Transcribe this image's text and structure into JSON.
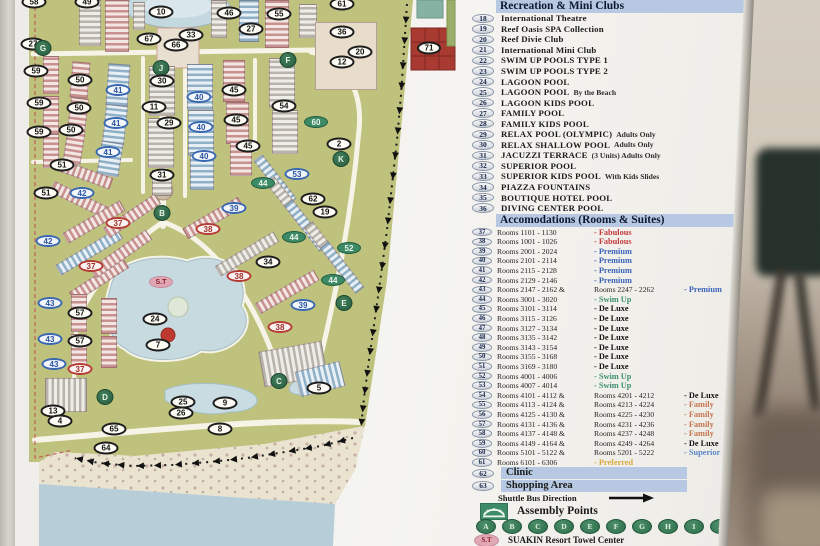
{
  "legend": {
    "section1_title": "Recreation & Mini Clubs",
    "recreation": [
      {
        "num": "18",
        "label": "International Theatre"
      },
      {
        "num": "19",
        "label": "Reef Oasis SPA Collection"
      },
      {
        "num": "20",
        "label": "Reef Divie Club"
      },
      {
        "num": "21",
        "label": "International Mini Club"
      },
      {
        "num": "22",
        "label": "SWIM UP POOLS TYPE 1"
      },
      {
        "num": "23",
        "label": "SWIM UP POOLS TYPE 2"
      },
      {
        "num": "24",
        "label": "LAGOON POOL"
      },
      {
        "num": "25",
        "label": "LAGOON POOL",
        "note": "By the Beach"
      },
      {
        "num": "26",
        "label": "LAGOON KIDS POOL"
      },
      {
        "num": "27",
        "label": "FAMILY POOL"
      },
      {
        "num": "28",
        "label": "FAMILY KIDS POOL"
      },
      {
        "num": "29",
        "label": "RELAX POOL (OLYMPIC)",
        "note": "Adults Only"
      },
      {
        "num": "30",
        "label": "RELAX SHALLOW POOL",
        "note": "Adults Only"
      },
      {
        "num": "31",
        "label": "JACUZZI TERRACE",
        "note": "(3 Units) Adults Only"
      },
      {
        "num": "32",
        "label": "SUPERIOR POOL"
      },
      {
        "num": "33",
        "label": "SUPERIOR KIDS POOL",
        "note": "With Kids Slides"
      },
      {
        "num": "34",
        "label": "PIAZZA FOUNTAINS"
      },
      {
        "num": "35",
        "label": "BOUTIQUE HOTEL POOL"
      },
      {
        "num": "36",
        "label": "DIVING CENTER POOL"
      }
    ],
    "section2_title": "Accomodations (Rooms & Suites)",
    "rooms": [
      {
        "num": "37",
        "rooms": "Rooms 1101 - 1130",
        "cat": "Fabulous",
        "style": "fab"
      },
      {
        "num": "38",
        "rooms": "Rooms 1001 - 1026",
        "cat": "Fabulous",
        "style": "fab"
      },
      {
        "num": "39",
        "rooms": "Rooms 2001 - 2024",
        "cat": "Premium",
        "style": "pre"
      },
      {
        "num": "40",
        "rooms": "Rooms 2101 - 2114",
        "cat": "Premium",
        "style": "pre"
      },
      {
        "num": "41",
        "rooms": "Rooms 2115 - 2128",
        "cat": "Premium",
        "style": "pre"
      },
      {
        "num": "42",
        "rooms": "Rooms 2129 - 2146",
        "cat": "Premium",
        "style": "pre"
      },
      {
        "num": "43",
        "rooms": "Rooms 2147 - 2162 &",
        "rooms2": "Rooms 2247 - 2262",
        "cat": "Premium",
        "style": "pre"
      },
      {
        "num": "44",
        "rooms": "Rooms 3001 - 3020",
        "cat": "Swim Up",
        "style": "swim"
      },
      {
        "num": "45",
        "rooms": "Rooms 3101 - 3114",
        "cat": "De Luxe",
        "style": "del"
      },
      {
        "num": "46",
        "rooms": "Rooms 3115 - 3126",
        "cat": "De Luxe",
        "style": "del"
      },
      {
        "num": "47",
        "rooms": "Rooms 3127 - 3134",
        "cat": "De Luxe",
        "style": "del"
      },
      {
        "num": "48",
        "rooms": "Rooms 3135 - 3142",
        "cat": "De Luxe",
        "style": "del"
      },
      {
        "num": "49",
        "rooms": "Rooms 3143 - 3154",
        "cat": "De Luxe",
        "style": "del"
      },
      {
        "num": "50",
        "rooms": "Rooms 3155 - 3168",
        "cat": "De Luxe",
        "style": "del"
      },
      {
        "num": "51",
        "rooms": "Rooms 3169 - 3180",
        "cat": "De Luxe",
        "style": "del"
      },
      {
        "num": "52",
        "rooms": "Rooms 4001 - 4006",
        "cat": "Swim Up",
        "style": "swim"
      },
      {
        "num": "53",
        "rooms": "Rooms 4007 - 4014",
        "cat": "Swim Up",
        "style": "swim"
      },
      {
        "num": "54",
        "rooms": "Rooms 4101 - 4112 &",
        "rooms2": "Rooms 4201 - 4212",
        "cat": "De Luxe",
        "style": "del"
      },
      {
        "num": "55",
        "rooms": "Rooms 4113 - 4124 &",
        "rooms2": "Rooms 4213 - 4224",
        "cat": "Family",
        "style": "fam"
      },
      {
        "num": "56",
        "rooms": "Rooms 4125 - 4130 &",
        "rooms2": "Rooms 4225 - 4230",
        "cat": "Family",
        "style": "fam"
      },
      {
        "num": "57",
        "rooms": "Rooms 4131 - 4136 &",
        "rooms2": "Rooms 4231 - 4236",
        "cat": "Family",
        "style": "fam"
      },
      {
        "num": "58",
        "rooms": "Rooms 4137 - 4148 &",
        "rooms2": "Rooms 4237 - 4248",
        "cat": "Family",
        "style": "fam"
      },
      {
        "num": "59",
        "rooms": "Rooms 4149 - 4164 &",
        "rooms2": "Rooms 4249 - 4264",
        "cat": "De Luxe",
        "style": "del"
      },
      {
        "num": "60",
        "rooms": "Rooms 5101 - 5122 &",
        "rooms2": "Rooms 5201 - 5222",
        "cat": "Superior Comfort",
        "style": "sup"
      },
      {
        "num": "61",
        "rooms": "Rooms 6101 - 6306",
        "cat": "Preferred",
        "style": "pref"
      }
    ],
    "facilities": [
      {
        "num": "62",
        "label": "Clinic"
      },
      {
        "num": "63",
        "label": "Shopping Area"
      }
    ],
    "shuttle_label": "Shuttle Bus Direction",
    "assembly_label": "Assembly Points",
    "assembly_letters": [
      "A",
      "B",
      "C",
      "D",
      "E",
      "F",
      "G",
      "H",
      "I",
      "J",
      "K"
    ],
    "towel_badge": "S.T",
    "towel_label": "SUAKIN Resort Towel Center"
  },
  "colors": {
    "fabulous": "#c23b3b",
    "premium": "#3c64b8",
    "swim_up": "#3f9070",
    "de_luxe": "#141414",
    "family": "#c4764f",
    "superior_comfort": "#5b84c8",
    "preferred": "#d8a93e",
    "legend_highlight": "#b7c9e2",
    "assembly_green": "#2c6e4a",
    "towel_pink": "#e2a7b5",
    "grass": "#bfc27c",
    "lagoon": "#c6dae0",
    "sea": "#b7cdd8",
    "beach": "#eae3d0",
    "block71_red": "#a83a32"
  },
  "map": {
    "markers": [
      {
        "l": "58",
        "x": 19,
        "y": 2,
        "t": "p"
      },
      {
        "l": "49",
        "x": 72,
        "y": 2,
        "t": "p"
      },
      {
        "l": "10",
        "x": 146,
        "y": 12,
        "t": "p"
      },
      {
        "l": "67",
        "x": 134,
        "y": 39,
        "t": "p"
      },
      {
        "l": "66",
        "x": 161,
        "y": 45,
        "t": "p"
      },
      {
        "l": "33",
        "x": 176,
        "y": 35,
        "t": "p"
      },
      {
        "l": "27",
        "x": 18,
        "y": 44,
        "t": "p"
      },
      {
        "l": "46",
        "x": 214,
        "y": 13,
        "t": "p"
      },
      {
        "l": "55",
        "x": 264,
        "y": 14,
        "t": "p"
      },
      {
        "l": "27",
        "x": 236,
        "y": 29,
        "t": "p"
      },
      {
        "l": "61",
        "x": 327,
        "y": 4,
        "t": "p"
      },
      {
        "l": "36",
        "x": 327,
        "y": 32,
        "t": "p"
      },
      {
        "l": "20",
        "x": 345,
        "y": 52,
        "t": "p"
      },
      {
        "l": "12",
        "x": 327,
        "y": 62,
        "t": "p"
      },
      {
        "l": "71",
        "x": 414,
        "y": 48,
        "t": "p71"
      },
      {
        "l": "G",
        "x": 28,
        "y": 48,
        "t": "a"
      },
      {
        "l": "J",
        "x": 146,
        "y": 68,
        "t": "a"
      },
      {
        "l": "F",
        "x": 273,
        "y": 60,
        "t": "a"
      },
      {
        "l": "59",
        "x": 21,
        "y": 71,
        "t": "p"
      },
      {
        "l": "50",
        "x": 65,
        "y": 80,
        "t": "p"
      },
      {
        "l": "30",
        "x": 147,
        "y": 81,
        "t": "p"
      },
      {
        "l": "41",
        "x": 103,
        "y": 90,
        "t": "b"
      },
      {
        "l": "40",
        "x": 184,
        "y": 97,
        "t": "b"
      },
      {
        "l": "45",
        "x": 219,
        "y": 90,
        "t": "p"
      },
      {
        "l": "59",
        "x": 24,
        "y": 103,
        "t": "p"
      },
      {
        "l": "50",
        "x": 64,
        "y": 108,
        "t": "p"
      },
      {
        "l": "11",
        "x": 139,
        "y": 107,
        "t": "p"
      },
      {
        "l": "54",
        "x": 269,
        "y": 106,
        "t": "p"
      },
      {
        "l": "60",
        "x": 301,
        "y": 122,
        "t": "g"
      },
      {
        "l": "41",
        "x": 101,
        "y": 123,
        "t": "b"
      },
      {
        "l": "29",
        "x": 154,
        "y": 123,
        "t": "p"
      },
      {
        "l": "40",
        "x": 186,
        "y": 127,
        "t": "b"
      },
      {
        "l": "45",
        "x": 221,
        "y": 120,
        "t": "p"
      },
      {
        "l": "59",
        "x": 24,
        "y": 132,
        "t": "p"
      },
      {
        "l": "50",
        "x": 56,
        "y": 130,
        "t": "p"
      },
      {
        "l": "41",
        "x": 93,
        "y": 152,
        "t": "b"
      },
      {
        "l": "40",
        "x": 189,
        "y": 156,
        "t": "b"
      },
      {
        "l": "45",
        "x": 233,
        "y": 146,
        "t": "p"
      },
      {
        "l": "2",
        "x": 324,
        "y": 144,
        "t": "p"
      },
      {
        "l": "K",
        "x": 326,
        "y": 159,
        "t": "a"
      },
      {
        "l": "51",
        "x": 47,
        "y": 165,
        "t": "p"
      },
      {
        "l": "31",
        "x": 147,
        "y": 175,
        "t": "p"
      },
      {
        "l": "53",
        "x": 282,
        "y": 174,
        "t": "b"
      },
      {
        "l": "51",
        "x": 31,
        "y": 193,
        "t": "p"
      },
      {
        "l": "42",
        "x": 67,
        "y": 193,
        "t": "b"
      },
      {
        "l": "44",
        "x": 248,
        "y": 183,
        "t": "g"
      },
      {
        "l": "62",
        "x": 298,
        "y": 199,
        "t": "p"
      },
      {
        "l": "19",
        "x": 310,
        "y": 212,
        "t": "p"
      },
      {
        "l": "39",
        "x": 219,
        "y": 208,
        "t": "b"
      },
      {
        "l": "B",
        "x": 147,
        "y": 213,
        "t": "a"
      },
      {
        "l": "37",
        "x": 103,
        "y": 223,
        "t": "r"
      },
      {
        "l": "38",
        "x": 193,
        "y": 229,
        "t": "r"
      },
      {
        "l": "42",
        "x": 33,
        "y": 241,
        "t": "b"
      },
      {
        "l": "44",
        "x": 279,
        "y": 237,
        "t": "g"
      },
      {
        "l": "52",
        "x": 334,
        "y": 248,
        "t": "g"
      },
      {
        "l": "34",
        "x": 253,
        "y": 262,
        "t": "p"
      },
      {
        "l": "37",
        "x": 76,
        "y": 266,
        "t": "r"
      },
      {
        "l": "38",
        "x": 224,
        "y": 276,
        "t": "r"
      },
      {
        "l": "S.T",
        "x": 146,
        "y": 282,
        "t": "st"
      },
      {
        "l": "44",
        "x": 318,
        "y": 280,
        "t": "g"
      },
      {
        "l": "43",
        "x": 35,
        "y": 303,
        "t": "b"
      },
      {
        "l": "39",
        "x": 288,
        "y": 305,
        "t": "b"
      },
      {
        "l": "E",
        "x": 329,
        "y": 303,
        "t": "a"
      },
      {
        "l": "57",
        "x": 65,
        "y": 313,
        "t": "p"
      },
      {
        "l": "24",
        "x": 140,
        "y": 319,
        "t": "p"
      },
      {
        "l": "38",
        "x": 265,
        "y": 327,
        "t": "r"
      },
      {
        "l": "43",
        "x": 35,
        "y": 339,
        "t": "b"
      },
      {
        "l": "57",
        "x": 65,
        "y": 341,
        "t": "p"
      },
      {
        "l": "",
        "x": 153,
        "y": 335,
        "t": "dot"
      },
      {
        "l": "7",
        "x": 143,
        "y": 345,
        "t": "p"
      },
      {
        "l": "43",
        "x": 39,
        "y": 364,
        "t": "b"
      },
      {
        "l": "37",
        "x": 65,
        "y": 369,
        "t": "r"
      },
      {
        "l": "C",
        "x": 264,
        "y": 381,
        "t": "a"
      },
      {
        "l": "5",
        "x": 304,
        "y": 388,
        "t": "p"
      },
      {
        "l": "D",
        "x": 90,
        "y": 397,
        "t": "a"
      },
      {
        "l": "13",
        "x": 38,
        "y": 411,
        "t": "p"
      },
      {
        "l": "4",
        "x": 45,
        "y": 421,
        "t": "p"
      },
      {
        "l": "25",
        "x": 168,
        "y": 402,
        "t": "p"
      },
      {
        "l": "26",
        "x": 166,
        "y": 413,
        "t": "p"
      },
      {
        "l": "9",
        "x": 210,
        "y": 403,
        "t": "p"
      },
      {
        "l": "8",
        "x": 205,
        "y": 429,
        "t": "p"
      },
      {
        "l": "65",
        "x": 99,
        "y": 429,
        "t": "p"
      },
      {
        "l": "64",
        "x": 91,
        "y": 448,
        "t": "p"
      }
    ]
  }
}
